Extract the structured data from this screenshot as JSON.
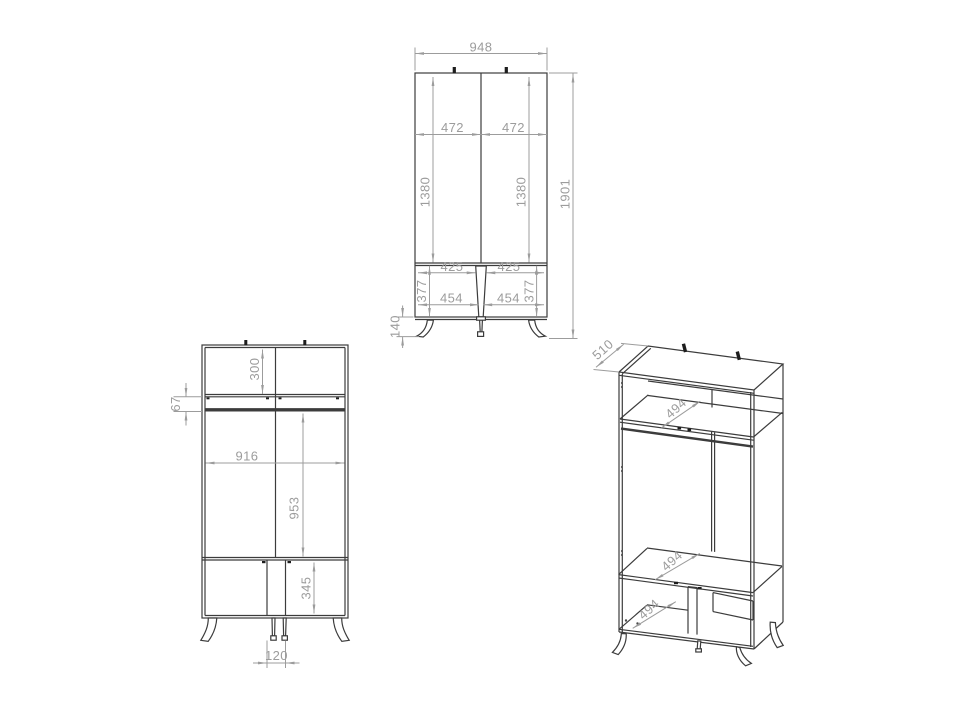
{
  "meta": {
    "title": "Wardrobe technical dimension drawing",
    "background": "#ffffff",
    "furniture_line_color": "#3c3c3c",
    "dimension_color": "#9c9c9c"
  },
  "views": {
    "front_exterior": {
      "dims": {
        "overall_width": "948",
        "door_width_left": "472",
        "door_width_right": "472",
        "door_height_left": "1380",
        "door_height_right": "1380",
        "overall_height": "1901",
        "drawer_opening_left": "425",
        "drawer_opening_right": "425",
        "drawer_front_left": "454",
        "drawer_front_right": "454",
        "drawer_section_height_left": "377",
        "drawer_section_height_right": "377",
        "leg_height": "140"
      }
    },
    "front_interior": {
      "dims": {
        "top_compartment_height": "300",
        "rail_offset": "67",
        "interior_width": "916",
        "hanging_space_height": "953",
        "bottom_compartment_height": "345",
        "center_divider_width": "120"
      }
    },
    "isometric": {
      "dims": {
        "depth": "510",
        "top_shelf_depth": "494",
        "middle_shelf_depth": "494",
        "bottom_shelf_depth": "494"
      }
    }
  }
}
